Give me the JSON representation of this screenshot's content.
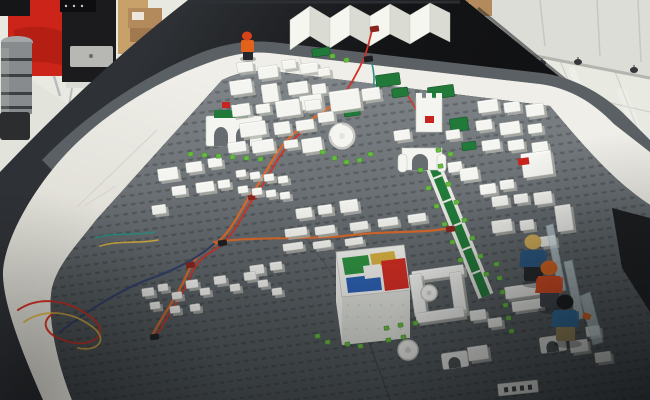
{
  "scene": {
    "label": "Photograph of a white LEGO model city built on a grey baseplate table with a white ring road, black table border, minifigures, coloured wires, and an office background with a red armchair and white cabinets",
    "width": 650,
    "height": 400
  },
  "palette": {
    "floor": "#e8e9e1",
    "floorDark": "#dcddd5",
    "grout": "#cfd0c8",
    "reflect": "#ffffff",
    "cabinet": "#dcddd7",
    "cabinetSeam": "#c6c7c0",
    "cabinetShadow": "#b4b5ae",
    "caster": "#35373a",
    "chair": "#cc2418",
    "chairDark": "#a01a10",
    "chrome": "#b9bcbd",
    "speaker": "#1b1b1d",
    "speakerTop": "#0e0e10",
    "grille": "#b7b8b3",
    "wood": "#c8a06a",
    "box": "#b38a5b",
    "boxDark": "#a07a4e",
    "label": "#ece7da",
    "robotLight": "#a3a7a8",
    "robotMid": "#878b8d",
    "robotDark": "#3c3f41",
    "robotBase": "#2b2d2f",
    "table": "#131416",
    "tableHi": "#2e3135",
    "road": "#efeee8",
    "roadLow": "#d8d6ce",
    "roadSeam": "#cfcdc6",
    "plateTop": "#808689",
    "plateMid": "#666c70",
    "plateLow": "#4a5053",
    "strip": "#5a6064",
    "stud": "#3a4043",
    "white": "#f4f4f0",
    "whiteShade": "#b2b3ac",
    "whiteEdge": "#c8c9c2",
    "whiteFace": "#e2e3dc",
    "parkGreen": "#217a39",
    "parkEdge": "#17552a",
    "lime": "#67ba3f",
    "limeEdge": "#3f8f2a",
    "red": "#c8231d",
    "darkBox": "#1c1e20",
    "redBox": "#8a241e",
    "wireOrange": "#d96a2b",
    "wireRed": "#cf3327",
    "wireBlue": "#32406b",
    "wireTeal": "#2e8f84",
    "wireYellow": "#d8b042",
    "roofGreen": "#2e9440",
    "roofYellow": "#d9b23f",
    "roofRed": "#d52b20",
    "roofBlue": "#2a5fb4",
    "transBlade": "#d7e7ec",
    "bladeEdge": "#aec7cf",
    "hairBlond": "#d9b35c",
    "capOrange": "#e2661d",
    "hairBlack": "#17181a",
    "torsoNavy": "#2b5a86",
    "torsoOrange": "#df4a1e",
    "torsoBlue": "#2e6da0",
    "legsDark": "#24272b",
    "legsGrey": "#3f444a",
    "legsKhaki": "#9f8a58",
    "workerOrange": "#e2621c",
    "workerHelmet": "#d8431a"
  },
  "background": {
    "casters": [
      [
        528,
        60
      ],
      [
        542,
        63
      ],
      [
        578,
        62
      ],
      [
        634,
        70
      ]
    ],
    "cabinetSeams": [
      [
        540,
        0,
        545,
        46
      ],
      [
        597,
        0,
        600,
        56
      ],
      [
        638,
        0,
        641,
        62
      ]
    ],
    "groutLines": [
      [
        558,
        56,
        588,
        128
      ],
      [
        612,
        64,
        646,
        150
      ],
      [
        520,
        82,
        650,
        112
      ]
    ],
    "reflections": [
      [
        572,
        70,
        602,
        142,
        6,
        0.3
      ],
      [
        622,
        92,
        650,
        164,
        9,
        0.22
      ],
      [
        545,
        58,
        562,
        96,
        3,
        0.28
      ]
    ]
  },
  "city": {
    "buildings": [
      [
        237,
        62,
        16,
        10
      ],
      [
        258,
        66,
        20,
        12
      ],
      [
        282,
        60,
        14,
        9
      ],
      [
        300,
        63,
        18,
        10
      ],
      [
        318,
        68,
        12,
        8
      ],
      [
        230,
        80,
        22,
        14
      ],
      [
        262,
        84,
        16,
        18
      ],
      [
        288,
        82,
        20,
        12
      ],
      [
        312,
        84,
        14,
        10
      ],
      [
        232,
        104,
        18,
        12
      ],
      [
        256,
        104,
        14,
        9
      ],
      [
        276,
        100,
        24,
        16
      ],
      [
        305,
        100,
        16,
        10
      ],
      [
        240,
        122,
        26,
        14
      ],
      [
        274,
        122,
        16,
        12
      ],
      [
        296,
        120,
        18,
        10
      ],
      [
        228,
        142,
        18,
        10
      ],
      [
        252,
        140,
        22,
        12
      ],
      [
        284,
        140,
        14,
        8
      ],
      [
        302,
        138,
        20,
        14
      ],
      [
        158,
        168,
        20,
        12
      ],
      [
        186,
        162,
        16,
        10
      ],
      [
        208,
        158,
        14,
        9
      ],
      [
        172,
        186,
        14,
        9
      ],
      [
        196,
        182,
        18,
        10
      ],
      [
        218,
        180,
        12,
        8
      ],
      [
        152,
        205,
        14,
        9
      ],
      [
        330,
        90,
        30,
        20
      ],
      [
        300,
        95,
        22,
        14
      ],
      [
        318,
        112,
        16,
        10
      ],
      [
        362,
        88,
        18,
        12
      ],
      [
        296,
        208,
        16,
        10
      ],
      [
        318,
        205,
        14,
        9
      ],
      [
        340,
        200,
        18,
        12
      ],
      [
        285,
        228,
        22,
        8
      ],
      [
        315,
        226,
        20,
        8
      ],
      [
        350,
        222,
        18,
        8
      ],
      [
        378,
        218,
        20,
        8
      ],
      [
        408,
        214,
        18,
        8
      ],
      [
        283,
        243,
        20,
        7
      ],
      [
        313,
        241,
        18,
        7
      ],
      [
        345,
        238,
        18,
        7
      ],
      [
        250,
        265,
        14,
        9
      ],
      [
        270,
        262,
        12,
        8
      ],
      [
        236,
        170,
        10,
        7
      ],
      [
        250,
        172,
        10,
        7
      ],
      [
        264,
        174,
        10,
        7
      ],
      [
        278,
        176,
        10,
        7
      ],
      [
        238,
        186,
        10,
        7
      ],
      [
        252,
        188,
        10,
        7
      ],
      [
        266,
        190,
        10,
        7
      ],
      [
        280,
        192,
        10,
        7
      ],
      [
        394,
        130,
        16,
        10
      ],
      [
        446,
        130,
        14,
        9
      ],
      [
        460,
        168,
        18,
        12
      ],
      [
        480,
        184,
        16,
        10
      ],
      [
        500,
        180,
        14,
        9
      ],
      [
        448,
        162,
        14,
        10
      ],
      [
        478,
        100,
        20,
        12
      ],
      [
        504,
        102,
        16,
        10
      ],
      [
        526,
        104,
        18,
        12
      ],
      [
        476,
        120,
        16,
        10
      ],
      [
        500,
        122,
        20,
        12
      ],
      [
        528,
        124,
        14,
        9
      ],
      [
        482,
        140,
        18,
        10
      ],
      [
        508,
        140,
        16,
        10
      ],
      [
        532,
        142,
        16,
        10
      ],
      [
        492,
        196,
        16,
        10
      ],
      [
        514,
        194,
        14,
        9
      ],
      [
        534,
        192,
        18,
        12
      ],
      [
        492,
        220,
        20,
        12
      ],
      [
        520,
        220,
        14,
        10
      ],
      [
        540,
        236,
        16,
        10
      ],
      [
        556,
        205,
        16,
        26
      ],
      [
        142,
        288,
        12,
        8
      ],
      [
        158,
        284,
        10,
        7
      ],
      [
        172,
        292,
        10,
        7
      ],
      [
        186,
        280,
        12,
        8
      ],
      [
        200,
        288,
        10,
        7
      ],
      [
        214,
        276,
        12,
        8
      ],
      [
        230,
        284,
        10,
        7
      ],
      [
        244,
        272,
        12,
        8
      ],
      [
        258,
        280,
        10,
        7
      ],
      [
        272,
        288,
        10,
        7
      ],
      [
        150,
        302,
        10,
        7
      ],
      [
        170,
        306,
        10,
        7
      ],
      [
        190,
        304,
        10,
        7
      ],
      [
        505,
        285,
        34,
        12
      ],
      [
        512,
        300,
        30,
        10
      ],
      [
        470,
        310,
        16,
        10
      ],
      [
        488,
        318,
        14,
        9
      ],
      [
        412,
        268,
        52,
        10
      ],
      [
        412,
        274,
        12,
        42
      ],
      [
        452,
        272,
        12,
        42
      ],
      [
        416,
        310,
        48,
        10
      ],
      [
        468,
        346,
        20,
        14
      ],
      [
        570,
        340,
        18,
        12
      ],
      [
        586,
        326,
        14,
        10
      ],
      [
        595,
        352,
        16,
        10
      ],
      [
        522,
        152,
        30,
        24
      ]
    ],
    "parks": [
      [
        376,
        74,
        24,
        12
      ],
      [
        428,
        86,
        26,
        12
      ],
      [
        450,
        118,
        18,
        13
      ],
      [
        392,
        88,
        16,
        9
      ],
      [
        344,
        108,
        16,
        8
      ],
      [
        312,
        48,
        18,
        8
      ],
      [
        462,
        142,
        14,
        8
      ]
    ],
    "studs": [
      [
        418,
        168
      ],
      [
        426,
        186
      ],
      [
        434,
        204
      ],
      [
        442,
        222
      ],
      [
        450,
        240
      ],
      [
        458,
        258
      ],
      [
        438,
        164
      ],
      [
        446,
        182
      ],
      [
        454,
        200
      ],
      [
        462,
        218
      ],
      [
        470,
        236
      ],
      [
        478,
        254
      ],
      [
        484,
        272
      ],
      [
        494,
        262
      ],
      [
        497,
        276
      ],
      [
        500,
        290
      ],
      [
        503,
        303
      ],
      [
        506,
        316
      ],
      [
        509,
        329
      ],
      [
        384,
        326
      ],
      [
        398,
        323
      ],
      [
        413,
        321
      ],
      [
        386,
        338
      ],
      [
        401,
        335
      ],
      [
        188,
        152
      ],
      [
        202,
        153
      ],
      [
        216,
        154
      ],
      [
        230,
        155
      ],
      [
        244,
        156
      ],
      [
        258,
        157
      ],
      [
        320,
        150
      ],
      [
        332,
        156
      ],
      [
        344,
        160
      ],
      [
        357,
        158
      ],
      [
        368,
        152
      ],
      [
        315,
        334
      ],
      [
        325,
        340
      ],
      [
        345,
        342
      ],
      [
        358,
        344
      ],
      [
        330,
        54
      ],
      [
        344,
        58
      ],
      [
        436,
        148
      ],
      [
        448,
        152
      ]
    ],
    "wires": [
      {
        "color": "wireOrange",
        "w": 2.4,
        "d": "M152,336 C168,306 178,296 188,272 C198,250 208,252 220,240 C234,227 242,207 250,196 C260,184 266,170 274,158 C282,144 294,132 306,124 C318,114 330,108 340,100"
      },
      {
        "color": "wireRed",
        "w": 1.8,
        "d": "M155,339 C171,309 181,299 191,275 C201,253 211,255 223,243 C237,230 245,210 253,199 C263,187 269,173 277,161 C285,147 297,135 309,127"
      },
      {
        "color": "wireBlue",
        "w": 2.2,
        "d": "M60,332 C95,305 125,288 152,278 C180,268 200,256 214,244"
      },
      {
        "color": "wireRed",
        "w": 2.0,
        "d": "M18,310 C40,295 70,300 92,318 C110,332 95,348 70,342 C45,336 38,322 55,312"
      },
      {
        "color": "wireYellow",
        "w": 1.8,
        "d": "M24,322 C46,307 74,312 94,328 C108,340 98,352 78,348"
      },
      {
        "color": "wireTeal",
        "w": 1.6,
        "d": "M95,238 C115,232 135,236 155,232"
      },
      {
        "color": "wireYellow",
        "w": 1.6,
        "d": "M100,246 C120,240 140,244 158,240"
      },
      {
        "color": "wireOrange",
        "w": 2.2,
        "d": "M214,242 C260,236 300,240 344,236 C388,230 420,234 450,228"
      },
      {
        "color": "wireRed",
        "w": 1.8,
        "d": "M340,100 C350,86 358,72 364,58 C368,48 370,38 372,30"
      },
      {
        "color": "wireTeal",
        "w": 1.6,
        "d": "M372,64 Q376,80 372,94"
      },
      {
        "color": "wireRed",
        "w": 1.5,
        "d": "M408,96 Q416,108 420,118"
      }
    ],
    "devices": [
      [
        186,
        262,
        "redBox"
      ],
      [
        218,
        240,
        "darkBox"
      ],
      [
        248,
        194,
        "redBox"
      ],
      [
        306,
        122,
        "darkBox"
      ],
      [
        338,
        98,
        "redBox"
      ],
      [
        364,
        56,
        "darkBox"
      ],
      [
        446,
        226,
        "redBox"
      ],
      [
        150,
        334,
        "darkBox"
      ],
      [
        370,
        26,
        "redBox"
      ]
    ],
    "avenue": {
      "x1": 428,
      "y1": 153,
      "x2": 486,
      "y2": 296,
      "halfOuter": 8,
      "halfInner": 4.5,
      "ticks": 5
    },
    "figures": [
      {
        "x": 522,
        "y": 232,
        "hair": "hairBlond",
        "torso": "torsoNavy",
        "legs": "legsDark",
        "blade": [
          [
            546,
            226
          ],
          [
            553,
            224
          ],
          [
            566,
            290
          ],
          [
            559,
            292
          ]
        ]
      },
      {
        "x": 538,
        "y": 258,
        "hair": "capOrange",
        "torso": "torsoOrange",
        "legs": "legsGrey",
        "blade": [
          [
            564,
            262
          ],
          [
            572,
            260
          ],
          [
            584,
            318
          ],
          [
            576,
            320
          ]
        ]
      },
      {
        "x": 554,
        "y": 292,
        "hair": "hairBlack",
        "torso": "torsoBlue",
        "legs": "legsKhaki",
        "blade": [
          [
            580,
            296
          ],
          [
            590,
            292
          ],
          [
            603,
            342
          ],
          [
            593,
            345
          ]
        ],
        "orangeBit": [
          584,
          312
        ]
      }
    ],
    "worker": {
      "x": 240,
      "y": 32
    },
    "pieces": [
      {
        "kind": "arch",
        "x": 442,
        "y": 352,
        "w": 26,
        "h": 16
      },
      {
        "kind": "arch",
        "x": 540,
        "y": 336,
        "w": 26,
        "h": 16
      },
      {
        "kind": "disc",
        "x": 408,
        "y": 350,
        "r": 10
      },
      {
        "kind": "disc",
        "x": 429,
        "y": 293,
        "r": 8
      },
      {
        "kind": "printed",
        "x": 498,
        "y": 382,
        "w": 40,
        "h": 12
      }
    ]
  }
}
